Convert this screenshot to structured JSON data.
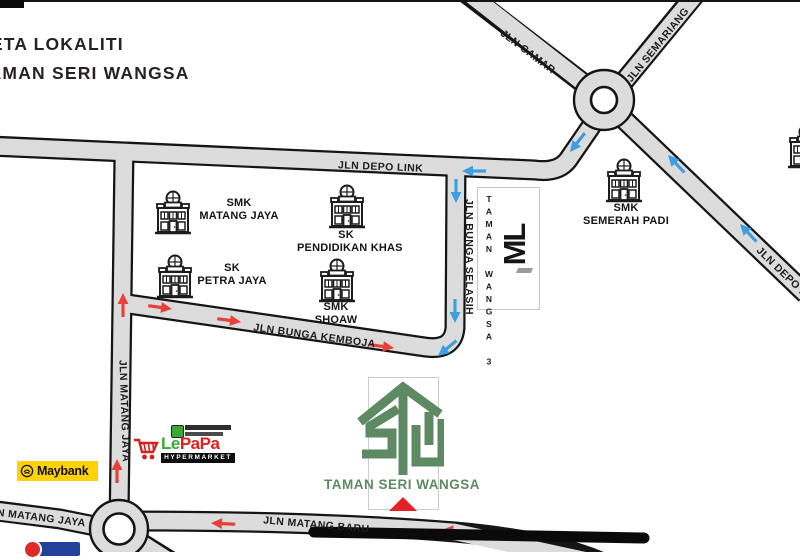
{
  "title": {
    "line1": "PETA LOKALITI",
    "line2": "TAMAN SERI WANGSA"
  },
  "roads": {
    "depo_link": "JLN DEPO LINK",
    "camar": "JLN CAMAR",
    "semariang": "JLN SEMARIANG",
    "depo_right": "JLN DEPO LINK",
    "bunga_selasih": "JLN BUNGA SELASIH",
    "matang_jaya_vertical": "JLN MATANG JAYA",
    "bunga_kemboja": "JLN BUNGA KEMBOJA",
    "matang_jaya_horizontal": "JLN MATANG JAYA",
    "matang_baru": "JLN MATANG BARU"
  },
  "schools": {
    "matang_jaya": {
      "line1": "SMK",
      "line2": "MATANG JAYA"
    },
    "pendidikan_khas": {
      "line1": "SK",
      "line2": "PENDIDIKAN KHAS"
    },
    "petra_jaya": {
      "line1": "SK",
      "line2": "PETRA JAYA"
    },
    "shoaw": {
      "line1": "SMK",
      "line2": "SHOAW"
    },
    "semerah_padi": {
      "line1": "SMK",
      "line2": "SEMERAH PADI"
    }
  },
  "development": {
    "name_vertical": "TAMAN WANGSA 3",
    "logo_mark": "ML"
  },
  "main_logo": {
    "name": "TAMAN SERI WANGSA"
  },
  "landmarks": {
    "maybank": "Maybank",
    "lepapa_le": "Le",
    "lepapa_papa": "PaPa",
    "lepapa_sub": "HYPERMARKET"
  },
  "colors": {
    "road_fill": "#dcdcdc",
    "road_casing": "#151515",
    "blue_arrow": "#3d9fe0",
    "red_arrow": "#e8413a",
    "stw_green": "#5e8a63",
    "maybank_yellow": "#ffd208",
    "marker_red": "#e32126"
  },
  "map_arrows": [
    {
      "x": 462,
      "y": 171,
      "angle": 180,
      "color": "blue"
    },
    {
      "x": 570,
      "y": 152,
      "angle": 128,
      "color": "blue"
    },
    {
      "x": 456,
      "y": 203,
      "angle": 90,
      "color": "blue"
    },
    {
      "x": 455,
      "y": 323,
      "angle": 90,
      "color": "blue"
    },
    {
      "x": 438,
      "y": 356,
      "angle": 140,
      "color": "blue"
    },
    {
      "x": 668,
      "y": 155,
      "angle": 227,
      "color": "blue"
    },
    {
      "x": 740,
      "y": 224,
      "angle": 227,
      "color": "blue"
    },
    {
      "x": 123,
      "y": 293,
      "angle": 270,
      "color": "red"
    },
    {
      "x": 117,
      "y": 459,
      "angle": 270,
      "color": "red"
    },
    {
      "x": 172,
      "y": 309,
      "angle": 8,
      "color": "red"
    },
    {
      "x": 241,
      "y": 322,
      "angle": 8,
      "color": "red"
    },
    {
      "x": 394,
      "y": 348,
      "angle": 8,
      "color": "red"
    },
    {
      "x": 211,
      "y": 523,
      "angle": 183,
      "color": "red"
    },
    {
      "x": 442,
      "y": 530,
      "angle": 184,
      "color": "red"
    }
  ]
}
